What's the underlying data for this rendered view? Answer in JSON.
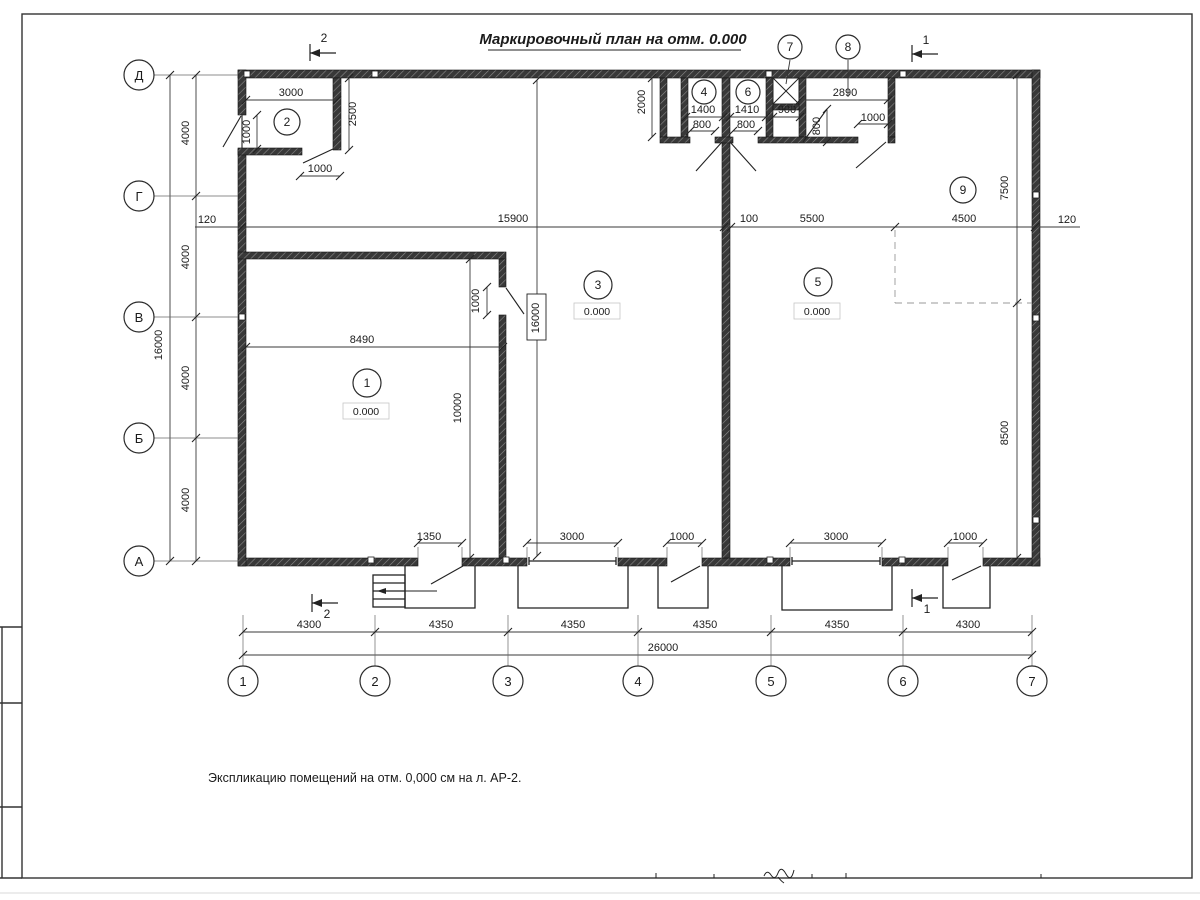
{
  "title": "Маркировочный план на отм. 0.000",
  "footnote": "Экспликацию помещений на отм. 0,000 см на л. АР-2.",
  "axes": {
    "rows": [
      "Д",
      "Г",
      "В",
      "Б",
      "А"
    ],
    "cols": [
      "1",
      "2",
      "3",
      "4",
      "5",
      "6",
      "7"
    ]
  },
  "rooms": {
    "r1": {
      "num": "1",
      "elev": "0.000"
    },
    "r2": {
      "num": "2"
    },
    "r3": {
      "num": "3",
      "elev": "0.000"
    },
    "r4": {
      "num": "4"
    },
    "r5": {
      "num": "5",
      "elev": "0.000"
    },
    "r6": {
      "num": "6"
    },
    "r7": {
      "num": "7"
    },
    "r8": {
      "num": "8"
    },
    "r9": {
      "num": "9"
    }
  },
  "sections": {
    "s1": "1",
    "s2": "2"
  },
  "dims": {
    "room2_width": "3000",
    "room2_depth": "2500",
    "room2_window": "1000",
    "room2_door": "1000",
    "top_row_depth": "2000",
    "room4_width": "1400",
    "room4_door": "800",
    "room6_width": "1410",
    "room6_door": "800",
    "shaft_width": "900",
    "closet_door_side": "800",
    "store_width": "2890",
    "store_door": "1000",
    "wall_off_left": "120",
    "span_main": "15900",
    "span_gap": "100",
    "span_5500": "5500",
    "span_4500": "4500",
    "wall_off_right": "120",
    "room1_width": "8490",
    "room1_door": "1000",
    "room1_depth": "10000",
    "zone_top": "7500",
    "zone_bottom": "8500",
    "entry_door_1350": "1350",
    "gate_left": "3000",
    "entry_door_mid": "1000",
    "gate_right": "3000",
    "entry_door_right": "1000",
    "bay_1": "4300",
    "bay_2": "4350",
    "bay_3": "4350",
    "bay_4": "4350",
    "bay_5": "4350",
    "bay_6": "4300",
    "total_width": "26000",
    "row_span_1": "4000",
    "row_span_2": "4000",
    "row_span_3": "4000",
    "row_span_4": "4000",
    "total_height": "16000"
  }
}
